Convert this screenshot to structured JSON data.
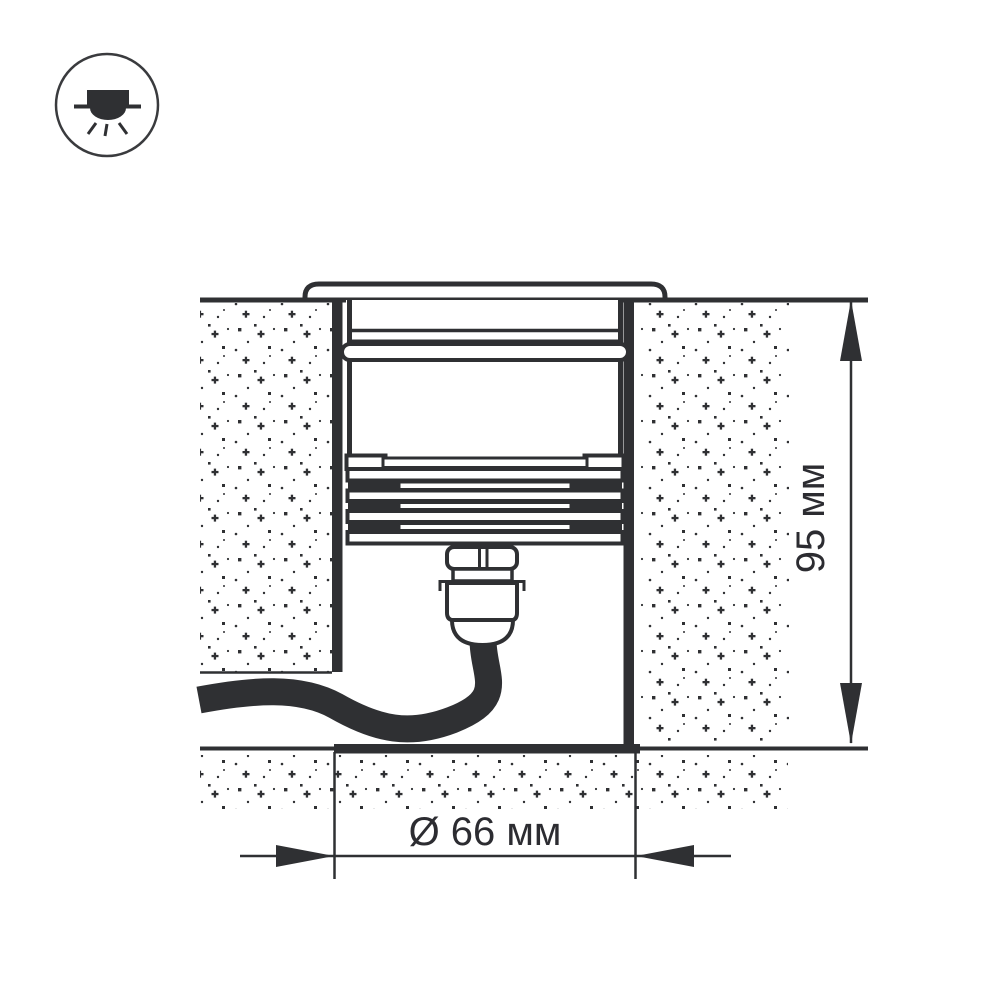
{
  "page": {
    "background": "#ffffff"
  },
  "legend_icon": {
    "meaning": "recessed-downlight-symbol"
  },
  "diagram": {
    "type": "technical-drawing",
    "subject": "in-ground recessed luminaire cross-section",
    "dimensions": {
      "diameter_label": "Ø 66 мм",
      "height_label": "95 мм"
    },
    "colors": {
      "line": "#2f3033",
      "text": "#2c2c31",
      "background": "#ffffff"
    }
  }
}
